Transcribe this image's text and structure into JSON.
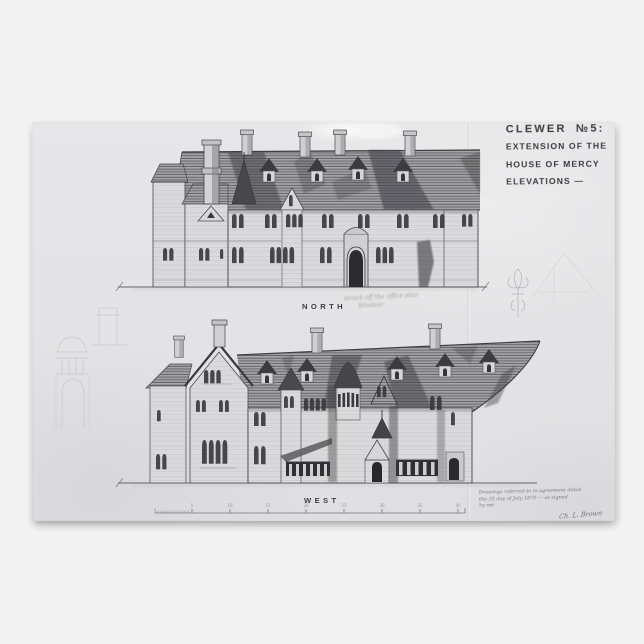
{
  "scene": {
    "background_color": "#f2f1f2"
  },
  "poster": {
    "paper_color": "#e4e4e6",
    "ink_color": "#3a3a3e",
    "pencil_color": "#bfbfc3",
    "title_block": {
      "line1": "CLEWER  №5:",
      "line2": "EXTENSION OF THE",
      "line3": "HOUSE OF MERCY",
      "line4": "ELEVATIONS —"
    },
    "elevations": [
      {
        "label": "NORTH"
      },
      {
        "label": "WEST"
      }
    ],
    "pencil_note": {
      "line1": "struck off the office plan",
      "line2": "Windsor"
    },
    "agreement_note": {
      "line1": "Drawings referred to in agreement dated",
      "line2": "the 25 day of July 1870 — as signed",
      "line3": "by me",
      "signature": "Ch. L. Brown"
    },
    "scale_bar": {
      "tick_labels": [
        "5",
        "10",
        "15",
        "20",
        "25",
        "30",
        "35",
        "40"
      ]
    }
  }
}
